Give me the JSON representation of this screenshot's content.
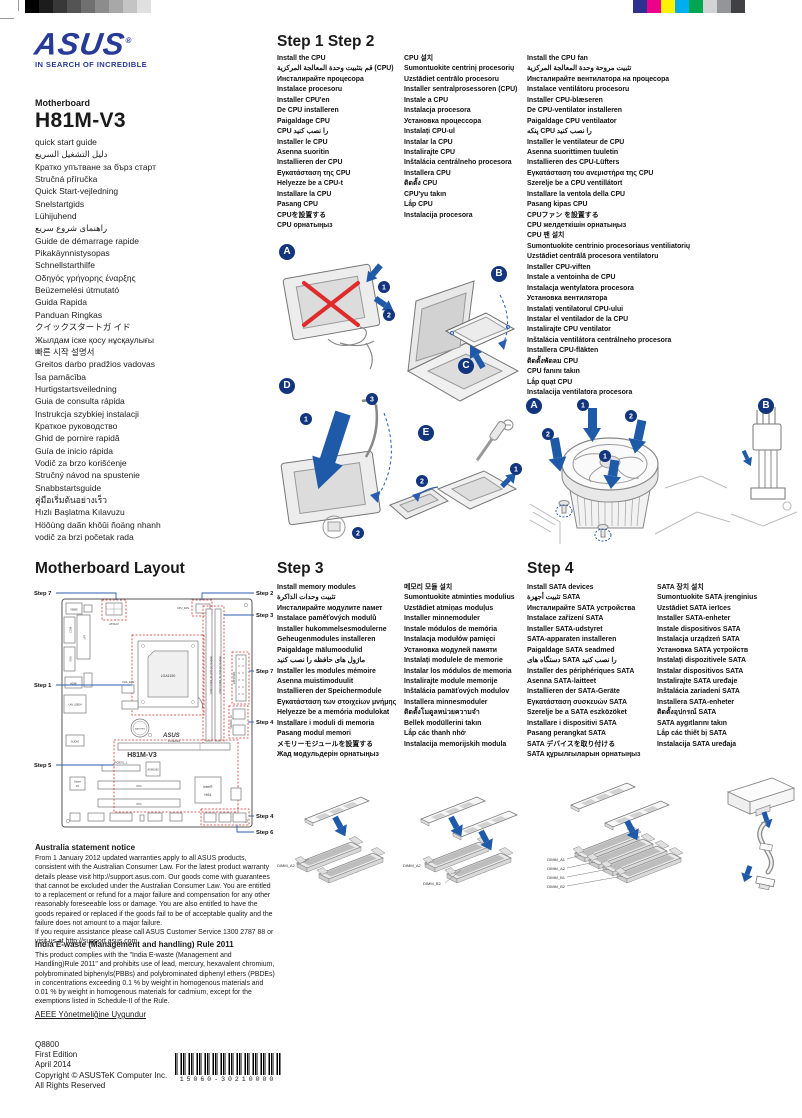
{
  "brand": {
    "name": "ASUS",
    "reg": "®",
    "tagline": "IN SEARCH OF INCREDIBLE"
  },
  "product": {
    "type": "Motherboard",
    "model": "H81M-V3"
  },
  "calibration": {
    "grayscale": [
      "#000000",
      "#1c1c1c",
      "#383838",
      "#545454",
      "#707070",
      "#8c8c8c",
      "#a8a8a8",
      "#c4c4c4",
      "#e0e0e0",
      "#ffffff"
    ],
    "colors": [
      "#2e3192",
      "#ec008c",
      "#fff200",
      "#00aeef",
      "#00a651",
      "#d1d3d4",
      "#939598",
      "#414042"
    ]
  },
  "languages": [
    "quick start guide",
    "دليل التشغيل السريع",
    "Кратко упътване за бърз старт",
    "Stručná příručka",
    "Quick Start-vejledning",
    "Snelstartgids",
    "Lühijuhend",
    "راهنمای شروع سریع",
    "Guide de démarrage rapide",
    "Pikakäynnistysopas",
    "Schnellstarthilfe",
    "Οδηγός γρήγορης έναρξης",
    "Beüzemelési útmutató",
    "Guida Rapida",
    "Panduan Ringkas",
    "クイックスタートガ イド",
    "Жылдам іске қосу нұсқаулығы",
    "빠른 시작 설명서",
    "Greitos darbo pradžios vadovas",
    "Īsa pamācība",
    "Hurtigstartsveiledning",
    "Guia de consulta rápida",
    "Instrukcja szybkiej instalacji",
    "Краткое руководство",
    "Ghid de pornire rapidă",
    "Guía de inicio rápida",
    "Vodič za brzo korišćenje",
    "Stručný návod na spustenie",
    "Snabbstartsguide",
    "คู่มือเริ่มต้นอย่างเร็ว",
    "Hızlı Başlatma Kılavuzu",
    "Höôùng daãn khôûi ñoäng nhanh",
    "vodič za brzi početak rada"
  ],
  "step12": {
    "title": "Step 1 Step 2",
    "cpu_col1": [
      "Install the CPU",
      "قم بتثبيت وحدة المعالجة المركزية (CPU)",
      "Инсталирайте процесора",
      "Instalace procesoru",
      "Installer CPU'en",
      "De CPU installeren",
      "Paigaldage CPU",
      "CPU را نصب کنید",
      "Installer le CPU",
      "Asenna suoritin",
      "Installieren der CPU",
      "Εγκατάσταση της CPU",
      "Helyezze be a CPU-t",
      "Installare la CPU",
      "Pasang CPU",
      "CPUを設置する",
      "CPU орнатыңыз"
    ],
    "cpu_col2": [
      "CPU 설치",
      "Sumontuokite centrinį procesorių",
      "Uzstādiet centrālo procesoru",
      "Installer sentralprosessoren (CPU)",
      "Instale a CPU",
      "Instalacja procesora",
      "Установка процессора",
      "Instalați CPU-ul",
      "Instalar la CPU",
      "Instalirajte CPU",
      "Inštalácia centrálneho procesora",
      "Installera CPU",
      "ติดตั้ง CPU",
      "CPU'yu takın",
      "Lắp CPU",
      "Instalacija procesora"
    ],
    "fan_col": [
      "Install the CPU fan",
      "تثبيت مروحة وحدة المعالجة المركزية",
      "Инсталирайте вентилатора на процесора",
      "Instalace ventilátoru procesoru",
      "Installer CPU-blæseren",
      "De CPU-ventilator installeren",
      "Paigaldage CPU ventilaator",
      "پنکه CPU را نصب کنید",
      "Installer le ventilateur de CPU",
      "Asenna suorittimen tuuletin",
      "Installieren des CPU-Lüfters",
      "Εγκατάσταση του ανεμιστήρα της CPU",
      "Szerelje be a CPU ventillátort",
      "Installare la ventola della CPU",
      "Pasang kipas CPU",
      "CPUファン を設置する",
      "CPU желдеткішін орнатыңыз",
      "CPU 팬 설치",
      "Sumontuokite centrinio procesoriaus ventiliatorių",
      "Uzstādiet centrālā procesora ventilatoru",
      "Installer CPU-viften",
      "Instale a ventoinha de CPU",
      "Instalacja wentylatora procesora",
      "Установка вентилятора",
      "Instalați ventilatorul CPU-ului",
      "Instalar el ventilador de la CPU",
      "Instalirajte CPU ventilator",
      "Inštalácia ventilátora centrálneho procesora",
      "Installera CPU-fläkten",
      "ติดตั้งพัดลม CPU",
      "CPU fanını takın",
      "Lắp quạt CPU",
      "Instalacija ventilatora procesora"
    ],
    "callouts": {
      "a": "A",
      "b": "B",
      "c": "C",
      "d": "D",
      "e": "E"
    },
    "fan_callouts": {
      "a": "A",
      "b": "B"
    }
  },
  "glyphs": {
    "n1": "1",
    "n2": "2",
    "n3": "3"
  },
  "layout": {
    "title": "Motherboard Layout",
    "left_labels": [
      "Step 7",
      "Step 1",
      "Step 5"
    ],
    "right_labels": [
      "Step 2",
      "Step 3",
      "Step 7",
      "Step 4",
      "Step 4",
      "Step 6"
    ],
    "board": {
      "kbms": "KBMS",
      "com": "COM",
      "lpt": "LPT",
      "vga": "VGA",
      "hdmi": "HDMI",
      "lan": "LAN_USB34",
      "audio": "AUDIO",
      "atx12v": "ATX12V",
      "cpu_fan": "CPU_FAN",
      "cha_fan": "CHA_FAN",
      "socket": "LGA1150",
      "battery": "BATTERY",
      "asus": "ASUS",
      "model": "H81M-V3",
      "pciex16": "PCIEX16",
      "pciex1": "PCIEX1_1",
      "asm": "ASM1083",
      "pci1": "PCI",
      "pci2": "PCI",
      "chipset_brand": "Intel®",
      "chipset": "H81",
      "superio_1": "Super",
      "superio_2": "I/O",
      "eatxpwr": "EATXPWR",
      "sata": "SATA6G_12",
      "dimm_a1": "DDR3 DIMM_A1 (240-pin module)",
      "dimm_b1": "DDR3 DIMM_B1 (240-pin module)"
    }
  },
  "step3": {
    "title": "Step 3",
    "col1": [
      "Install memory modules",
      "تثبيت وحدات الذاكرة",
      "Инсталирайте модулите памет",
      "Instalace paměťových modulů",
      "Installer hukommelsesmodulerne",
      "Geheugenmodules installeren",
      "Paigaldage mälumoodulid",
      "ماژول های حافظه را نصب کنید",
      "Installer les modules mémoire",
      "Asenna muistimoduulit",
      "Installieren der Speichermodule",
      "Εγκατάσταση των στοιχείων μνήμης",
      "Helyezze be a memória modulokat",
      "Installare i moduli di memoria",
      "Pasang modul memori",
      "メモリーモジュールを設置する",
      "Жад модульдерін орнатыңыз"
    ],
    "col2": [
      "메모리 모듈 설치",
      "Sumontuokite atminties modulius",
      "Uzstādiet atmiņas moduļus",
      "Installer minnemoduler",
      "Instale módulos de memória",
      "Instalacja modułów pamięci",
      "Установка модулей памяти",
      "Instalați modulele de memorie",
      "Instalar los módulos de memoria",
      "Instalirajte module memorije",
      "Inštalácia pamäťových modulov",
      "Installera minnesmoduler",
      "ติดตั้งโมดูลหน่วยความจำ",
      "Bellek modüllerini takın",
      "Lắp các thanh nhớ",
      "Instalacija memorijskih modula"
    ],
    "dimm_g1": [
      "DIMM_A2"
    ],
    "dimm_g2": [
      "DIMM_A2",
      "DIMM_B2"
    ],
    "dimm_g3": [
      "DIMM_A1",
      "DIMM_A2",
      "DIMM_B1",
      "DIMM_B2"
    ]
  },
  "step4": {
    "title": "Step 4",
    "col1": [
      "Install SATA devices",
      "تثبيت أجهزة SATA",
      "Инсталирайте SATA устройства",
      "Instalace zařízení SATA",
      "Installer SATA-udstyret",
      "SATA-apparaten installeren",
      "Paigaldage SATA seadmed",
      "دستگاه های SATA را نصب کنید",
      "Installer des périphériques SATA",
      "Asenna SATA-laitteet",
      "Installieren der SATA-Geräte",
      "Εγκατάσταση συσκευών SATA",
      "Szerelje be a SATA eszközöket",
      "Installare i dispositivi SATA",
      "Pasang perangkat SATA",
      "SATA デバイスを取り付ける",
      "SATA құрылғыларын орнатыңыз"
    ],
    "col2": [
      "SATA 장치 설치",
      "Sumontuokite SATA įrenginius",
      "Uzstādiet SATA ierīces",
      "Installer SATA-enheter",
      "Instale dispositivos SATA",
      "Instalacja urządzeń SATA",
      "Установка SATA устройств",
      "Instalați dispozitivele SATA",
      "Instalar dispositivos SATA",
      "Instalirajte SATA uređaje",
      "Inštalácia zariadení SATA",
      "Installera SATA-enheter",
      "ติดตั้งอุปกรณ์ SATA",
      "SATA aygıtlarını takın",
      "Lắp các thiết bị SATA",
      "Instalacija SATA uređaja"
    ]
  },
  "notices": {
    "australia_title": "Australia statement notice",
    "australia_body1": "From 1 January 2012 updated warranties apply to all ASUS products, consistent with the Australian Consumer Law. For the latest product warranty details please visit http://support.asus.com. Our goods come with guarantees that cannot be excluded under the Australian Consumer Law. You are entitled to a replacement or refund for a major failure and compensation for any other reasonably foreseeable loss or damage. You are also entitled to have the goods repaired or replaced if the goods fail to be of acceptable quality and the failure does not amount to a major failure.",
    "australia_body2": "If you require assistance please call ASUS Customer Service 1300 2787 88 or visit us at http://support.asus.com",
    "india_title": "India E-waste (Management and handling) Rule 2011",
    "india_body": "This product complies with the \"India E-waste (Management and Handling)Rule 2011\" and prohibits use of lead, mercury, hexavalent chromium, polybrominated biphenyls(PBBs) and polybrominated diphenyl ethers (PBDEs) in concentrations exceeding 0.1 % by weight in homogenous materials and 0.01 % by weight in homogenous materials for cadmium, except for the exemptions listed in Schedule-II of the Rule.",
    "aeee": "AEEE Yönetmeliğine Uygundur"
  },
  "colophon": [
    "Q8800",
    "First Edition",
    "April 2014",
    "Copyright © ASUSTeK Computer Inc.",
    "All Rights Reserved"
  ],
  "barcode_text": "15060-30210000"
}
